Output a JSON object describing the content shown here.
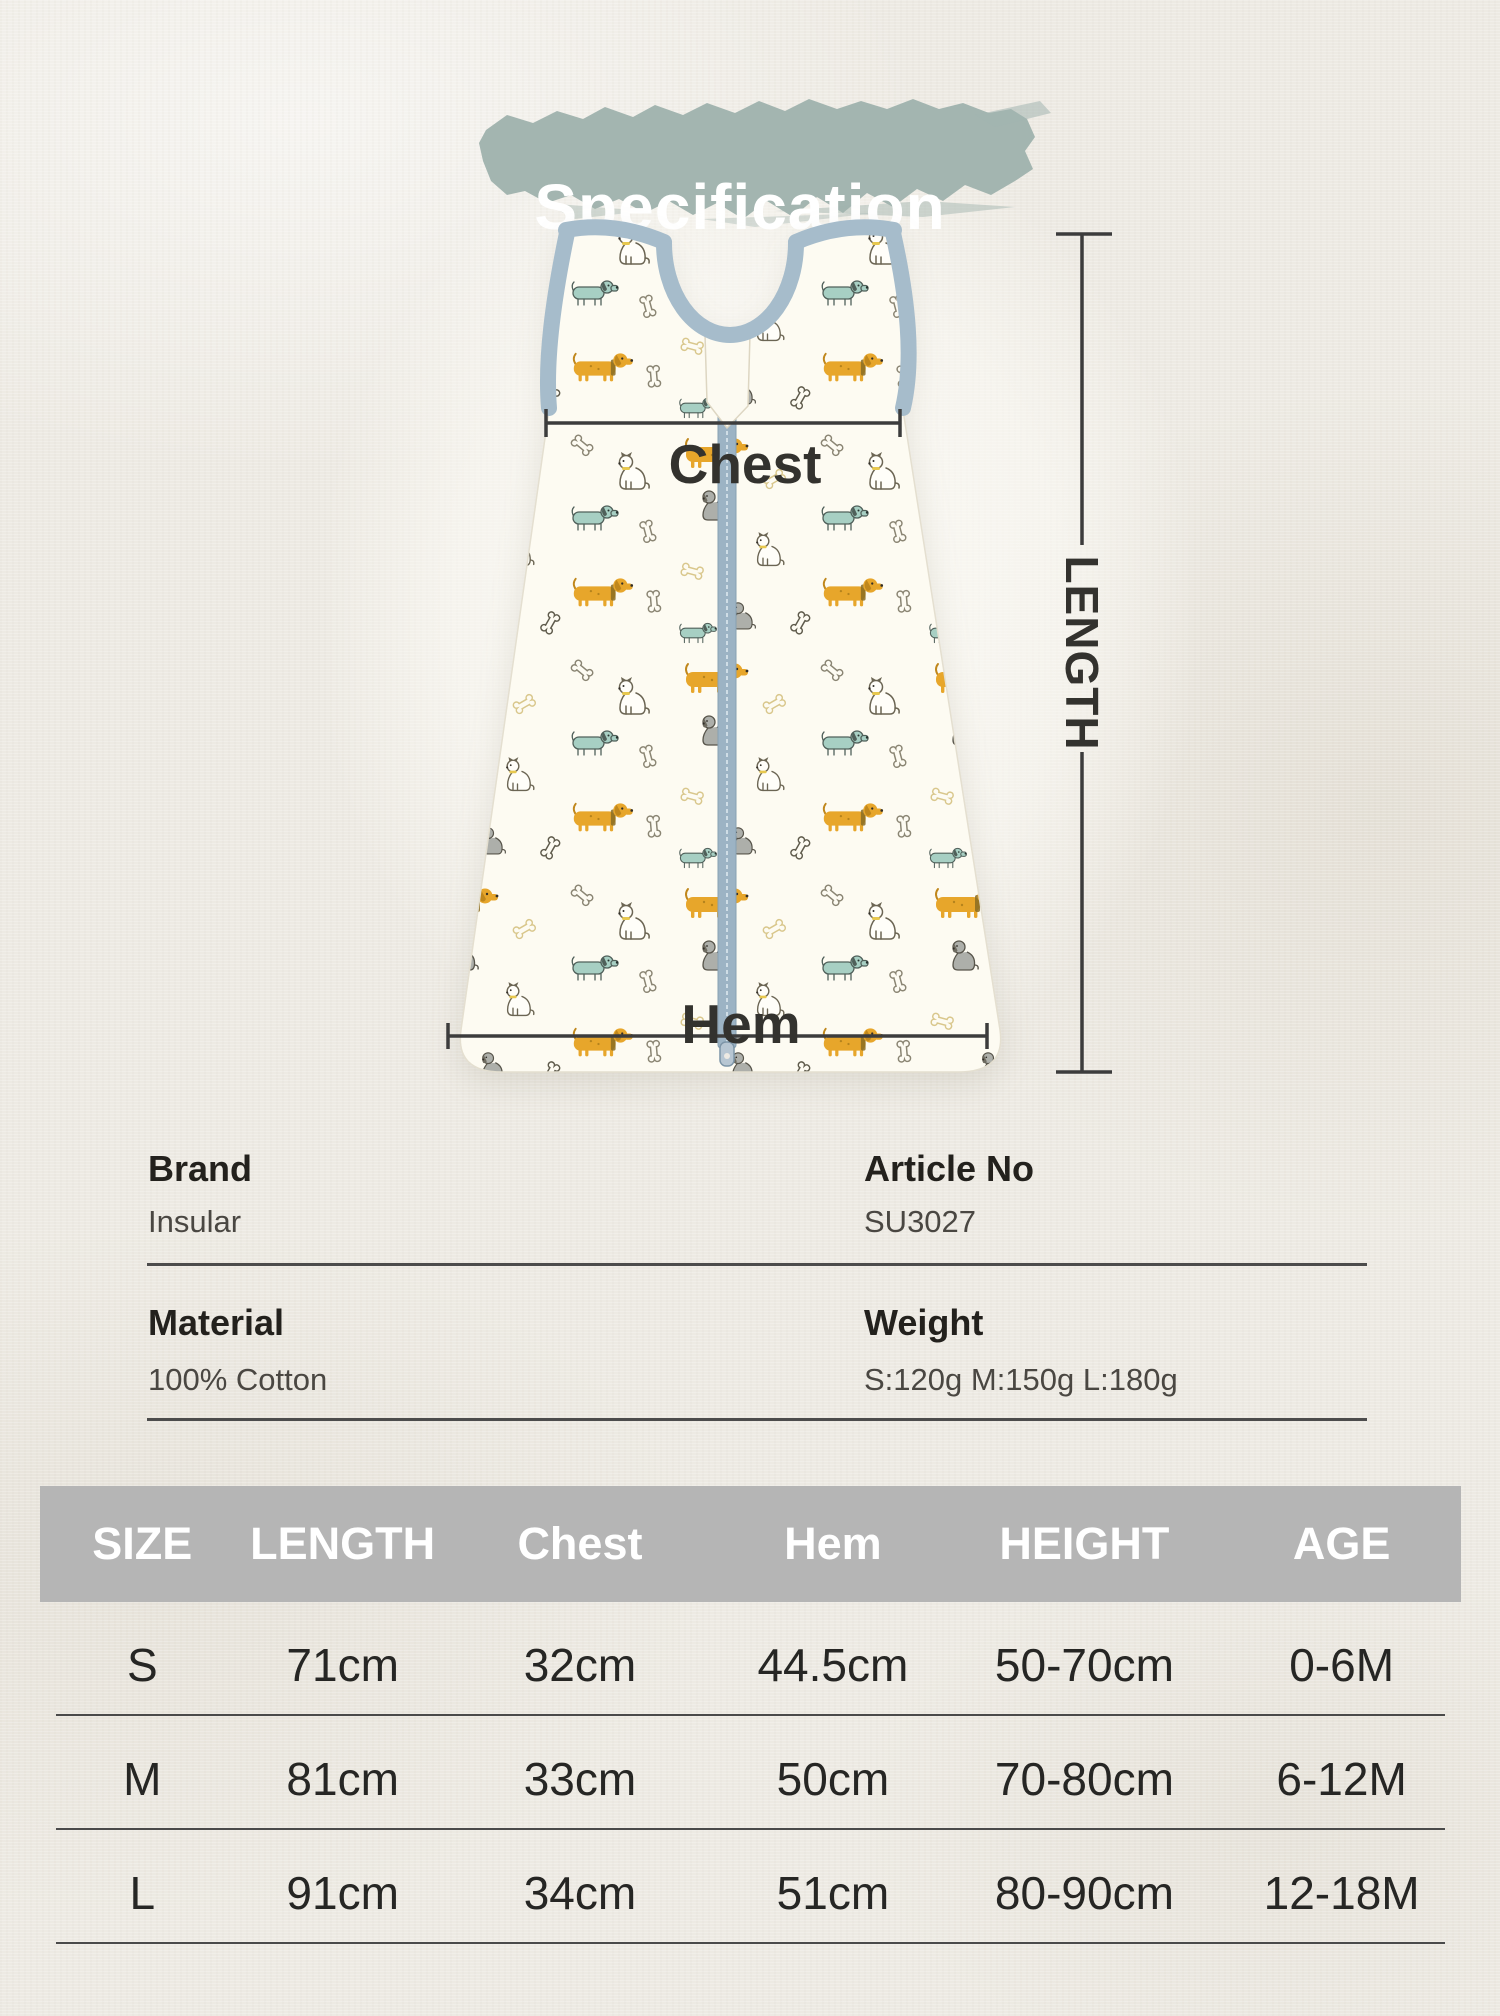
{
  "title": {
    "text": "Specification"
  },
  "colors": {
    "paper": "#edeae3",
    "brush": "#a3b5b0",
    "title_text": "#ffffff",
    "fabric": "#fdfbf2",
    "trim": "#a6bccb",
    "zipper": "#9cb3c4",
    "measure_line": "#3c3c3c",
    "measure_label": "#33322e",
    "table_header_bg": "#b5b5b5",
    "table_header_text": "#ffffff",
    "table_cell_text": "#262624",
    "info_label": "#23211d",
    "info_value": "#4a4742",
    "divider": "#4c4c4c",
    "pattern": {
      "dachshund_body": "#e7a62b",
      "dachshund_dark": "#c0871c",
      "terrier_outline": "#6b6553",
      "gray_dog": "#adafaa",
      "teal_dog": "#a7cfc3",
      "bone_gray": "#8a8573",
      "bone_gold": "#d9c78c",
      "collar_yellow": "#e7c84f"
    }
  },
  "diagram": {
    "chest_label": "Chest",
    "hem_label": "Hem",
    "length_label": "LENGTH"
  },
  "info": {
    "brand_label": "Brand",
    "brand_value": "Insular",
    "article_label": "Article No",
    "article_value": "SU3027",
    "material_label": "Material",
    "material_value": "100% Cotton",
    "weight_label": "Weight",
    "weight_value": "S:120g M:150g L:180g"
  },
  "size_table": {
    "headers": [
      "SIZE",
      "LENGTH",
      "Chest",
      "Hem",
      "HEIGHT",
      "AGE"
    ],
    "rows": [
      [
        "S",
        "71cm",
        "32cm",
        "44.5cm",
        "50-70cm",
        "0-6M"
      ],
      [
        "M",
        "81cm",
        "33cm",
        "50cm",
        "70-80cm",
        "6-12M"
      ],
      [
        "L",
        "91cm",
        "34cm",
        "51cm",
        "80-90cm",
        "12-18M"
      ]
    ]
  }
}
